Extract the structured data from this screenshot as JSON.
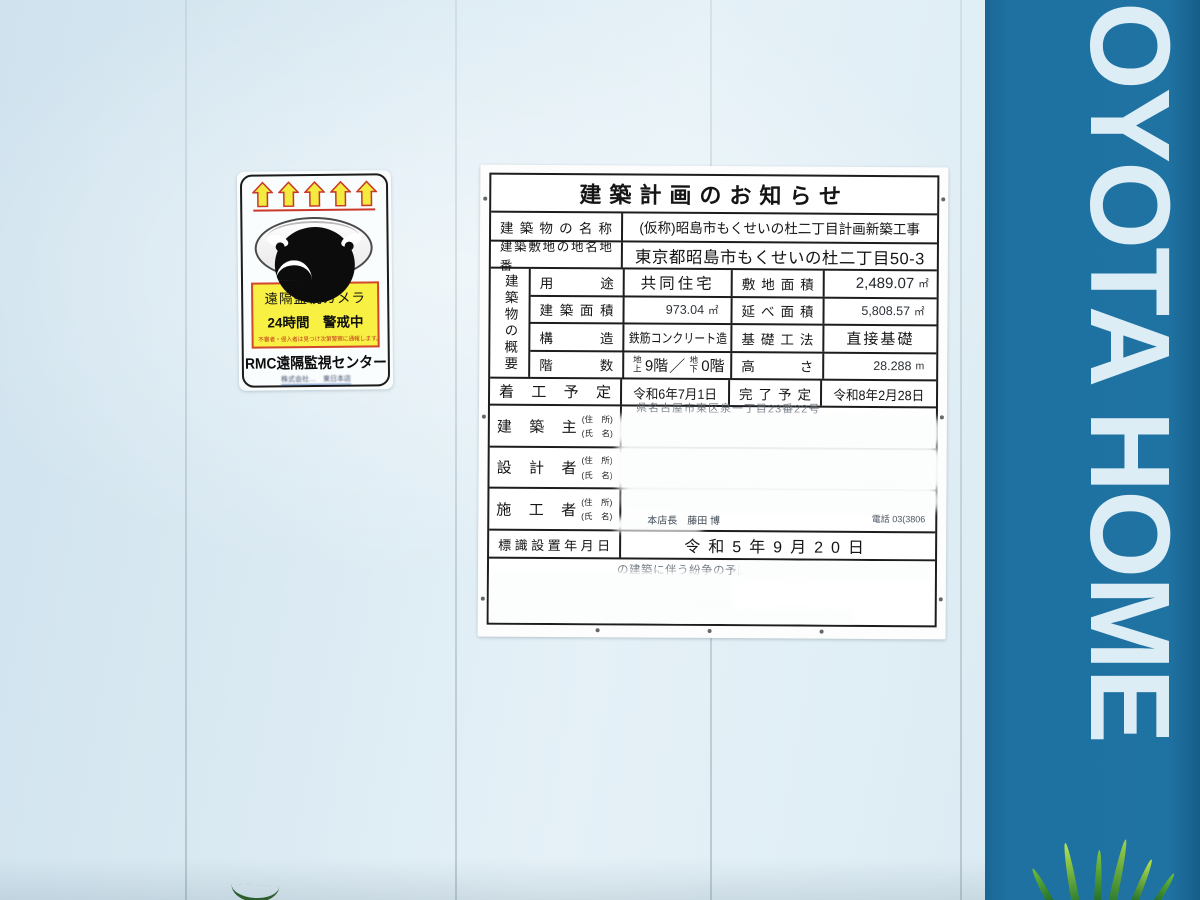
{
  "sticker": {
    "warning_line1": "遠隔監視カメラ",
    "warning_line2": "24時間　警戒中",
    "warning_small": "不審者・侵入者は見つけ次第警察に通報します。",
    "org_name": "RMC遠隔監視センター",
    "company_line": "株式会社…　東日本店",
    "box_bg": "#f8f043",
    "box_border": "#d2482e"
  },
  "board": {
    "title": "建築計画のお知らせ",
    "building_name": {
      "label": "建築物の名称",
      "value": "(仮称)昭島市もくせいの杜二丁目計画新築工事"
    },
    "site_address": {
      "label": "建築敷地の地名地番",
      "value": "東京都昭島市もくせいの杜二丁目50-3"
    },
    "overview_label": "建築物の概要",
    "usage": {
      "label": "用途",
      "value": "共同住宅"
    },
    "site_area": {
      "label": "敷地面積",
      "value": "2,489.07",
      "unit": "㎡"
    },
    "building_area": {
      "label": "建築面積",
      "value": "973.04",
      "unit": "㎡"
    },
    "total_floor_area": {
      "label": "延べ面積",
      "value": "5,808.57",
      "unit": "㎡"
    },
    "structure": {
      "label": "構造",
      "value": "鉄筋コンクリート造"
    },
    "foundation": {
      "label": "基礎工法",
      "value": "直接基礎"
    },
    "floors": {
      "label": "階数",
      "above_label": "地上",
      "above_value": "9階",
      "separator": "／",
      "below_label": "地下",
      "below_value": "0階"
    },
    "height": {
      "label": "高さ",
      "value": "28.288",
      "unit": "m"
    },
    "start_date": {
      "label": "着工予定",
      "value": "令和6年7月1日"
    },
    "completion_date": {
      "label": "完了予定",
      "value": "令和8年2月28日"
    },
    "owner": {
      "label": "建築主",
      "addr_label": "(住　所)",
      "name_label": "(氏　名)",
      "visible_fragment": "県名古屋市東区泉一丁目23番22号"
    },
    "designer": {
      "label": "設計者",
      "addr_label": "(住　所)",
      "name_label": "(氏　名)",
      "visible_fragment": "株"
    },
    "contractor": {
      "label": "施工者",
      "addr_label": "(住　所)",
      "name_label": "(氏　名)",
      "fragment_left": "本店長　藤田 博",
      "fragment_right": "電話 03(3806"
    },
    "sign_date": {
      "label": "標識設置年月日",
      "value": "令和5年9月20日"
    },
    "note_fragment": "の建築に伴う紛争の予防と調整に関",
    "note_fragment2": "れ"
  },
  "banner": {
    "text": "OYOTA HOME",
    "bg": "#1e71a1",
    "fg": "#dcedf6"
  }
}
